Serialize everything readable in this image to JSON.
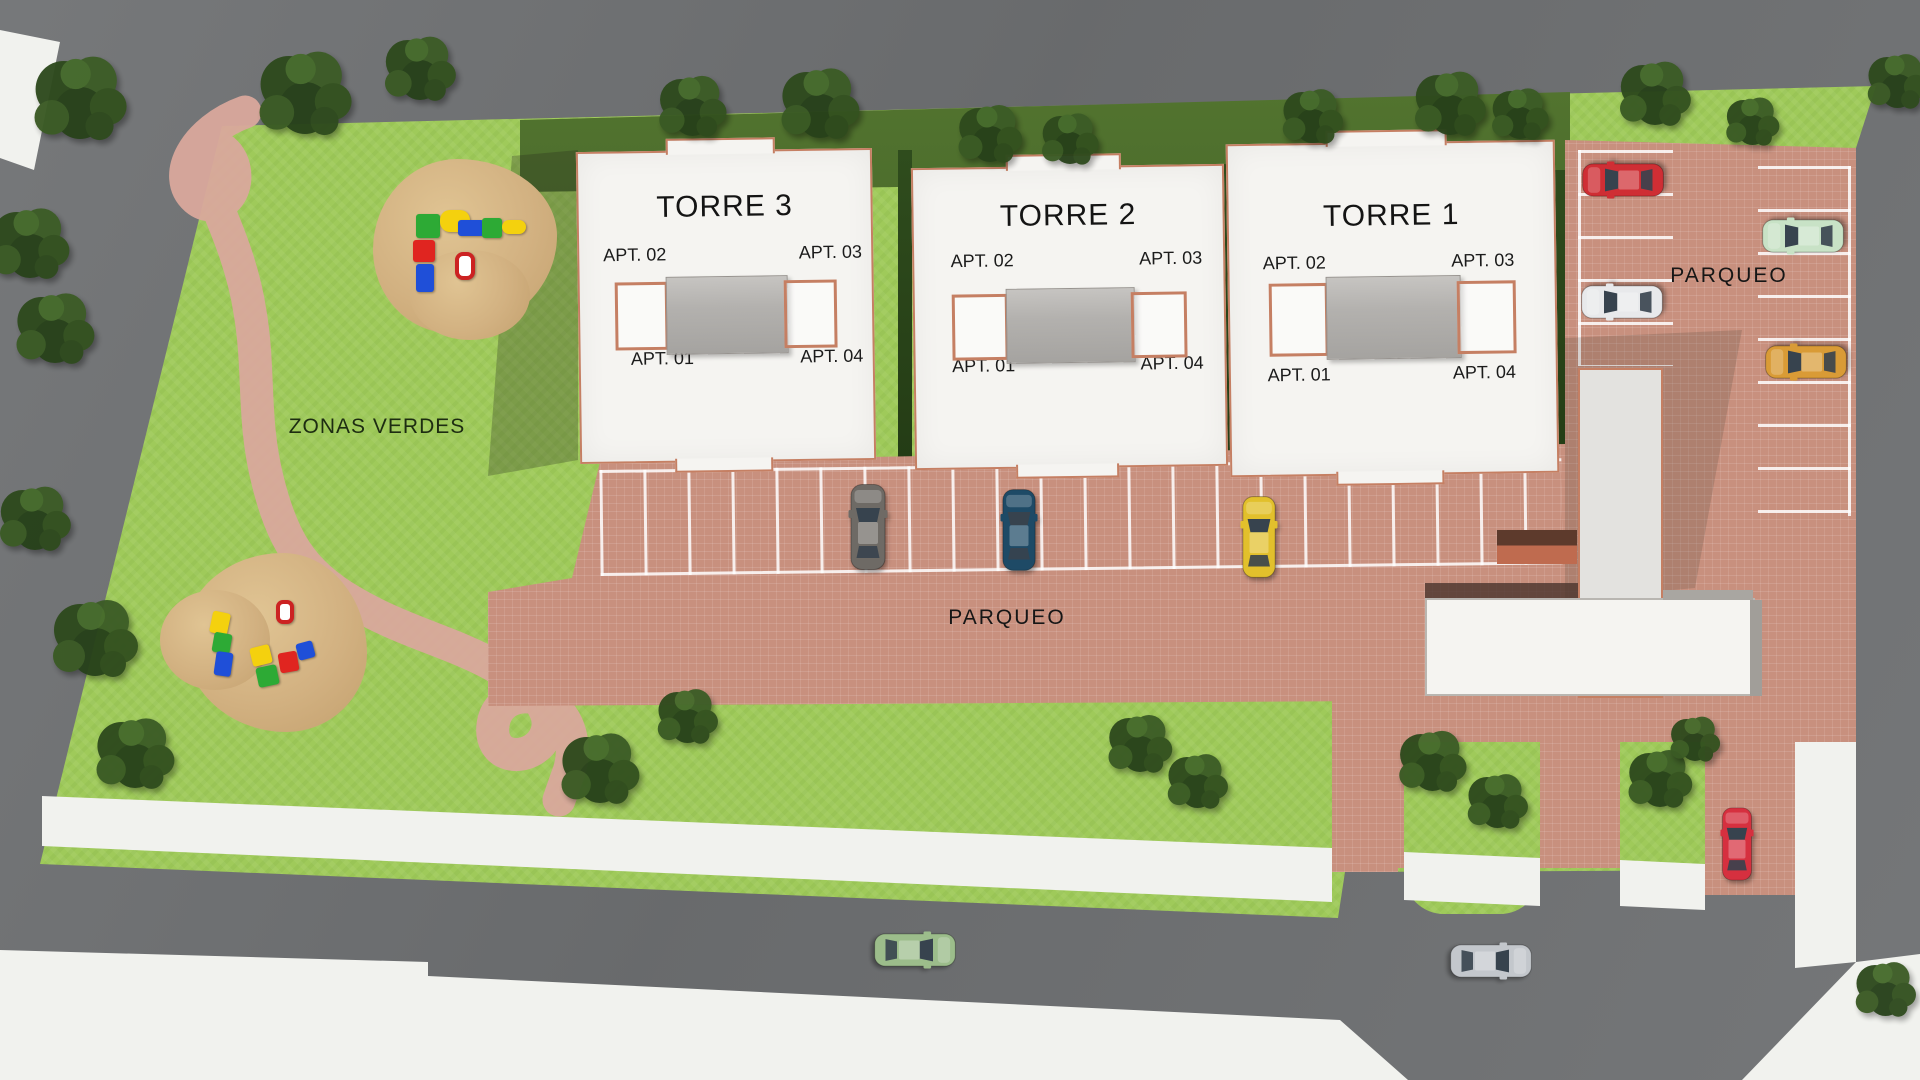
{
  "labels": {
    "zonas_verdes": "ZONAS VERDES",
    "parqueo_central": "PARQUEO",
    "parqueo_east": "PARQUEO"
  },
  "towers": [
    {
      "name": "TORRE 3",
      "apt_02": "APT. 02",
      "apt_03": "APT. 03",
      "apt_01": "APT. 01",
      "apt_04": "APT. 04"
    },
    {
      "name": "TORRE 2",
      "apt_02": "APT. 02",
      "apt_03": "APT. 03",
      "apt_01": "APT. 01",
      "apt_04": "APT. 04"
    },
    {
      "name": "TORRE 1",
      "apt_02": "APT. 02",
      "apt_03": "APT. 03",
      "apt_01": "APT. 01",
      "apt_04": "APT. 04"
    }
  ],
  "colors": {
    "road": "#6f7173",
    "sidewalk": "#f1f2ee",
    "lawn": "#9fca5a",
    "hedge": "#3b5a23",
    "paving": "#c8907e",
    "path": "#d9a89c",
    "sand": "#d7ba8a",
    "building": "#f5f4f1",
    "outline": "#c57f63"
  },
  "cars": [
    {
      "name": "suv-gray-central-lot",
      "color": "#6e6a65"
    },
    {
      "name": "sedan-blue-central-lot",
      "color": "#1e4a66"
    },
    {
      "name": "sedan-yellow-central-lot",
      "color": "#e2c02c"
    },
    {
      "name": "car-red-east-lot",
      "color": "#cf2e34"
    },
    {
      "name": "car-white-east-lot",
      "color": "#e8e9eb"
    },
    {
      "name": "car-mint-east-lot",
      "color": "#c8e2c6"
    },
    {
      "name": "car-orange-east-lot",
      "color": "#d99b36"
    },
    {
      "name": "car-red-curbside",
      "color": "#d6303f"
    },
    {
      "name": "sedan-silver-road",
      "color": "#c3c7cc"
    },
    {
      "name": "car-green-road",
      "color": "#9cbd8b"
    }
  ]
}
